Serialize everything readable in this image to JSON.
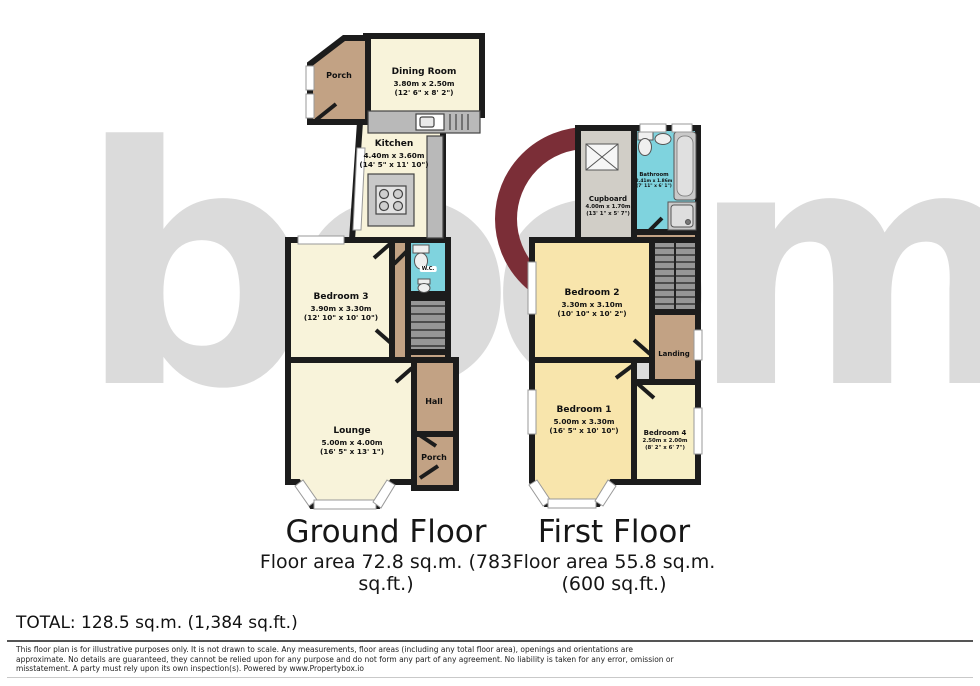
{
  "watermark": {
    "text": "boom",
    "text_color": "#dbdbdb",
    "ring_color": "#7b2e37"
  },
  "palette": {
    "wall": "#1c1c1c",
    "room_cream": "#f8f3da",
    "room_tan": "#c2a284",
    "room_wet_cyan": "#7fd3de",
    "room_warm": "#f8e5ac",
    "room_pale": "#f7efc6",
    "cupboard_grey": "#d1cec7",
    "counter_grey": "#b9b9b9",
    "stairs_grey": "#969696"
  },
  "ground_floor": {
    "title": "Ground Floor",
    "area_lines": [
      "Floor area 72.8 sq.m. (783",
      "sq.ft.)"
    ],
    "rooms": {
      "porch_top": {
        "name": "Porch"
      },
      "dining": {
        "name": "Dining Room",
        "dim_m": "3.80m x 2.50m",
        "dim_ft": "(12' 6\" x 8' 2\")"
      },
      "kitchen": {
        "name": "Kitchen",
        "dim_m": "4.40m x 3.60m",
        "dim_ft": "(14' 5\" x 11' 10\")"
      },
      "wc": {
        "name": "W.C."
      },
      "bedroom3": {
        "name": "Bedroom 3",
        "dim_m": "3.90m x 3.30m",
        "dim_ft": "(12' 10\" x 10' 10\")"
      },
      "lounge": {
        "name": "Lounge",
        "dim_m": "5.00m x 4.00m",
        "dim_ft": "(16' 5\" x 13' 1\")"
      },
      "hall": {
        "name": "Hall"
      },
      "porch_bottom": {
        "name": "Porch"
      }
    }
  },
  "first_floor": {
    "title": "First Floor",
    "area_lines": [
      "Floor area 55.8 sq.m.",
      "(600 sq.ft.)"
    ],
    "rooms": {
      "cupboard": {
        "name": "Cupboard",
        "dim_m": "4.00m x 1.70m",
        "dim_ft": "(13' 1\" x 5' 7\")"
      },
      "bathroom": {
        "name": "Bathroom",
        "dim_m": "2.41m x 1.86m",
        "dim_ft": "(7' 11\" x 6' 1\")"
      },
      "bedroom2": {
        "name": "Bedroom 2",
        "dim_m": "3.30m x 3.10m",
        "dim_ft": "(10' 10\" x 10' 2\")"
      },
      "landing": {
        "name": "Landing"
      },
      "bedroom1": {
        "name": "Bedroom 1",
        "dim_m": "5.00m x 3.30m",
        "dim_ft": "(16' 5\" x 10' 10\")"
      },
      "bedroom4": {
        "name": "Bedroom 4",
        "dim_m": "2.50m x 2.00m",
        "dim_ft": "(8' 2\" x 6' 7\")"
      }
    }
  },
  "total": "TOTAL: 128.5 sq.m. (1,384 sq.ft.)",
  "disclaimer_lines": [
    "This floor plan is for illustrative purposes only. It is not drawn to scale. Any measurements, floor areas (including any total floor area), openings and orientations are",
    "approximate. No details are guaranteed, they cannot be relied upon for any purpose and do not form any part of any agreement. No liability is taken for any error, omission or",
    "misstatement. A party must rely upon its own inspection(s). Powered by www.Propertybox.io"
  ]
}
